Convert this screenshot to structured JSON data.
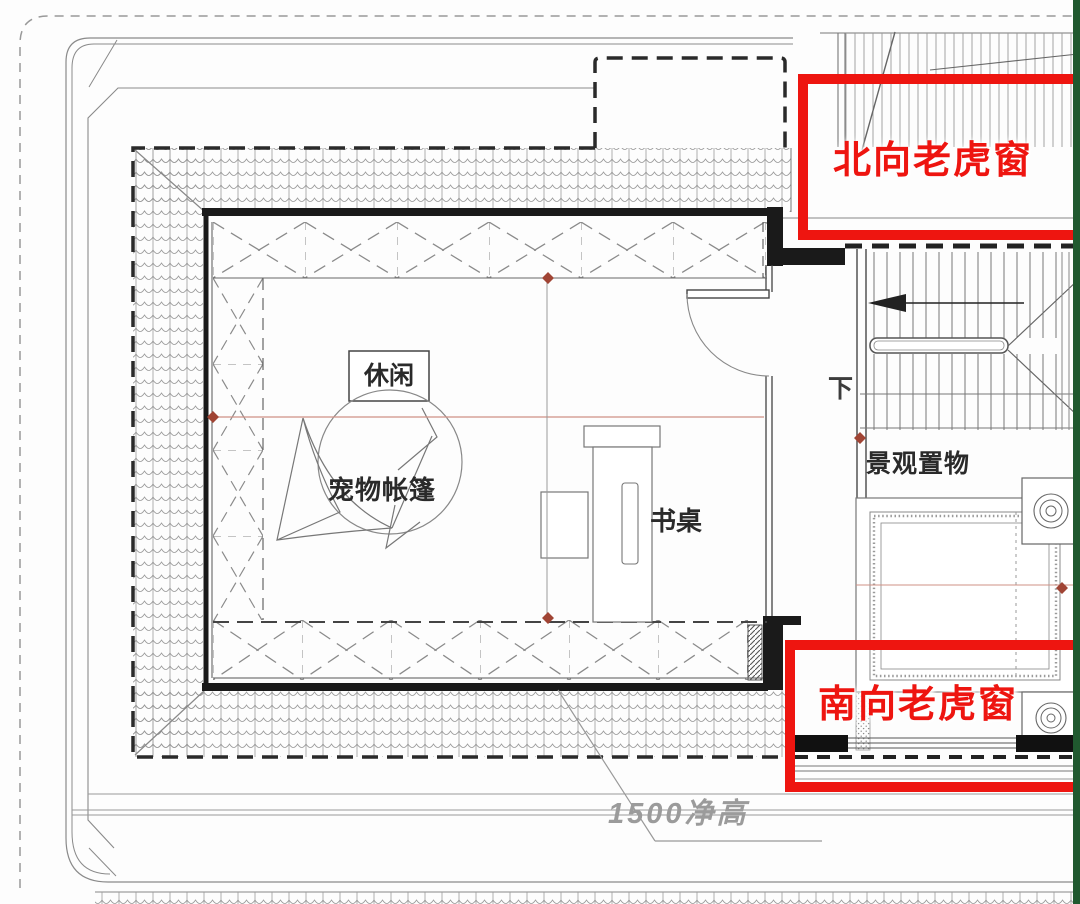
{
  "annotations": {
    "north_dormer": {
      "label": "北向老虎窗"
    },
    "south_dormer": {
      "label": "南向老虎窗"
    }
  },
  "labels": {
    "leisure": "休闲",
    "pet_tent": "宠物帐篷",
    "desk": "书桌",
    "landscape_shelf": "景观置物",
    "stair_down": "下",
    "clear_height": "1500净高"
  },
  "colors": {
    "highlight_red": "#ee1510",
    "wall_black": "#1a1a1a",
    "line_gray": "#777777",
    "guide_rose": "#cf9186",
    "marker_red": "#a04434",
    "edge_green": "#20592f",
    "cad_text": "#2a2a2a",
    "dim_text": "#9b9b9b",
    "background": "#fdfdfd"
  }
}
